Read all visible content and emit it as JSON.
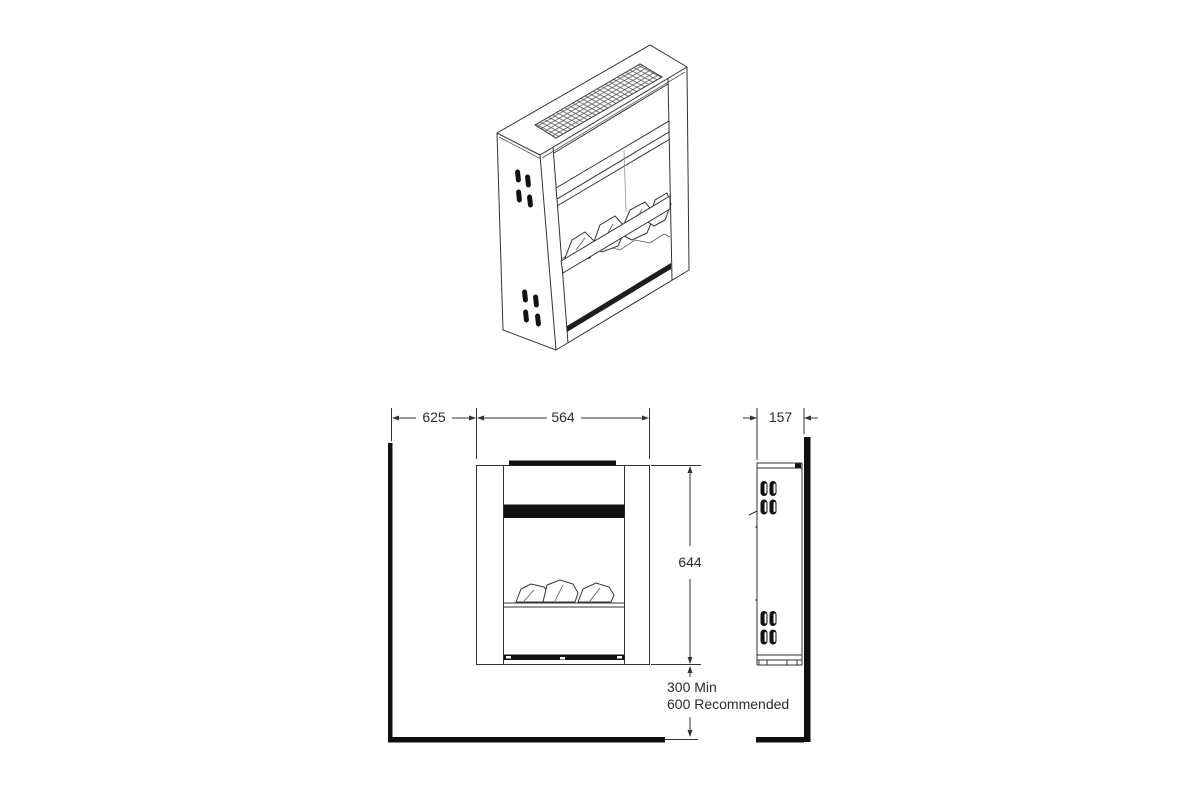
{
  "drawing": {
    "dimensions": {
      "wall_to_unit": "625",
      "unit_width": "564",
      "unit_depth": "157",
      "unit_height": "644",
      "floor_clearance_min": "300 Min",
      "floor_clearance_recommended": "600 Recommended"
    },
    "colors": {
      "line": "#333333",
      "solid_black": "#111111",
      "background": "#ffffff"
    }
  }
}
